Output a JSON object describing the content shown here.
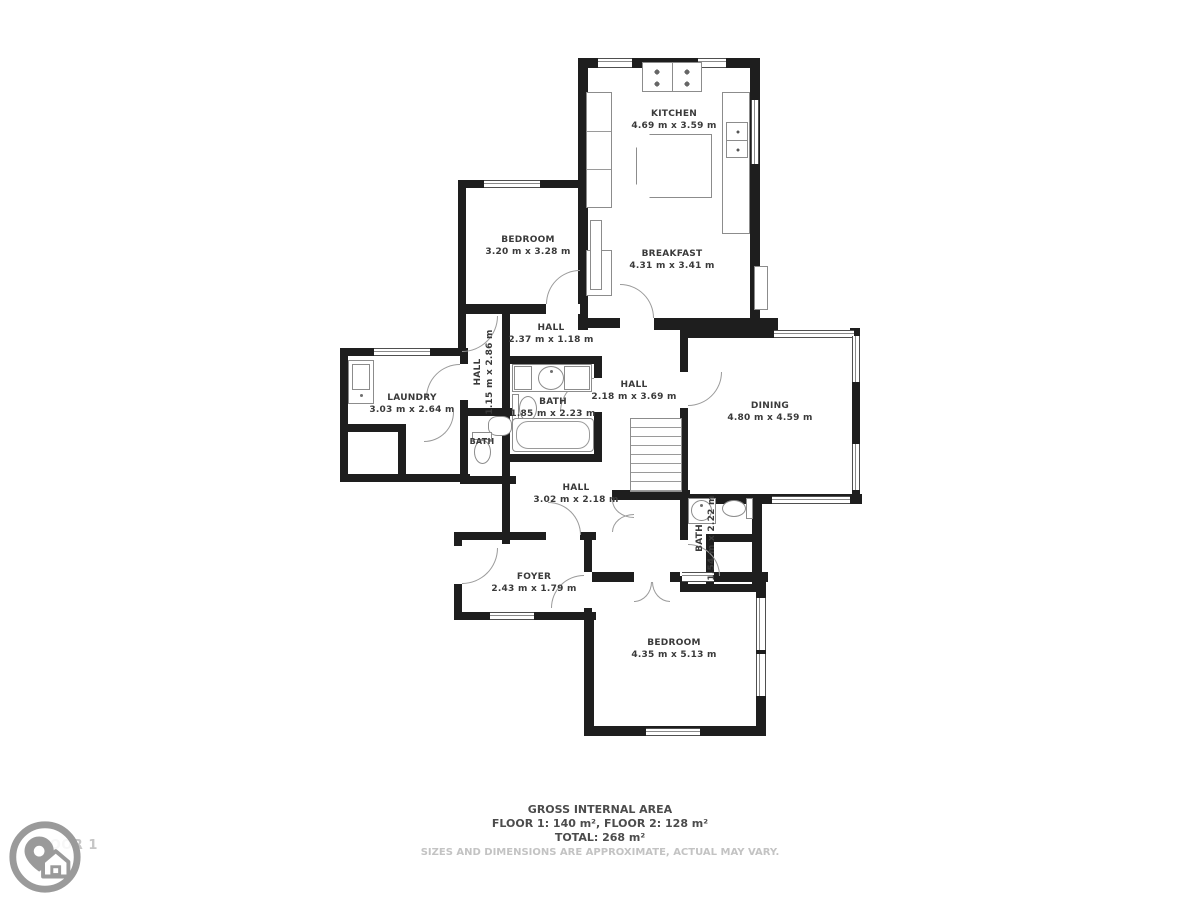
{
  "rooms": [
    {
      "name": "KITCHEN",
      "dims": "4.69 m x 3.59 m"
    },
    {
      "name": "BEDROOM",
      "dims": "3.20 m x 3.28 m"
    },
    {
      "name": "BREAKFAST",
      "dims": "4.31 m x 3.41 m"
    },
    {
      "name": "HALL",
      "dims": "2.37 m x 1.18 m"
    },
    {
      "name": "HALL",
      "dims": "1.15 m x 2.86 m"
    },
    {
      "name": "LAUNDRY",
      "dims": "3.03 m x 2.64 m"
    },
    {
      "name": "BATH",
      "dims": ""
    },
    {
      "name": "BATH",
      "dims": "1.85 m x 2.23 m"
    },
    {
      "name": "HALL",
      "dims": "2.18 m x 3.69 m"
    },
    {
      "name": "DINING",
      "dims": "4.80 m x 4.59 m"
    },
    {
      "name": "HALL",
      "dims": "3.02 m x 2.18 m"
    },
    {
      "name": "BATH",
      "dims": "1.54 m x 2.22 m"
    },
    {
      "name": "FOYER",
      "dims": "2.43 m x 1.79 m"
    },
    {
      "name": "BEDROOM",
      "dims": "4.35 m x 5.13 m"
    }
  ],
  "footer": {
    "title": "GROSS INTERNAL AREA",
    "line1": "FLOOR 1: 140 m², FLOOR 2: 128 m²",
    "line2": "TOTAL: 268 m²",
    "disclaimer": "SIZES AND DIMENSIONS ARE APPROXIMATE, ACTUAL MAY VARY."
  },
  "badge": {
    "label": "FLOOR 1"
  },
  "colors": {
    "wall": "#1e1e1e",
    "line": "#8c8c8c",
    "text": "#3a3a3a",
    "muted": "#c3c3c3",
    "logo": "#9a9a9a"
  }
}
